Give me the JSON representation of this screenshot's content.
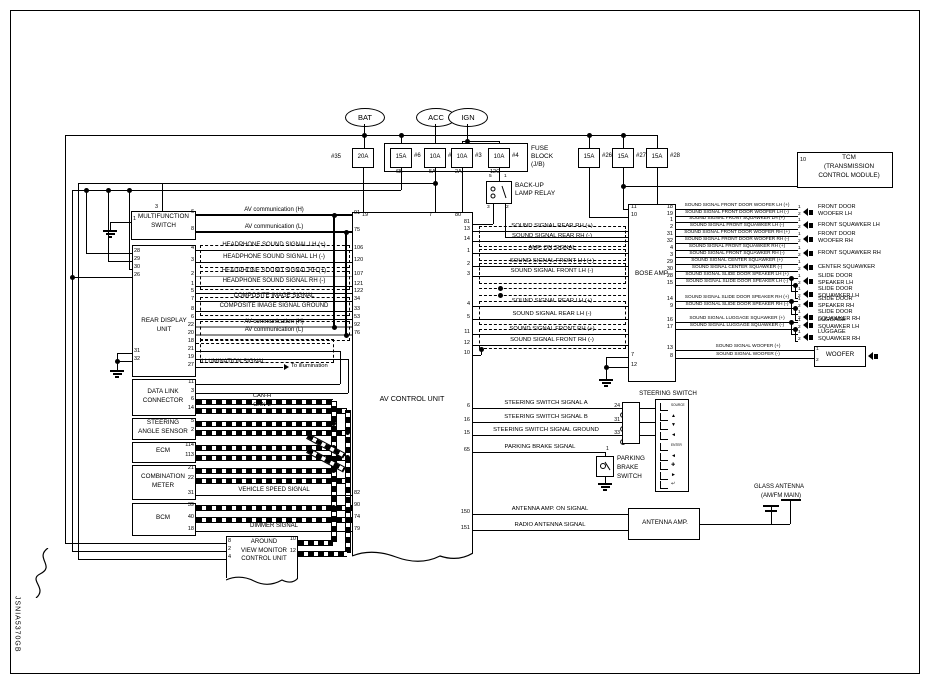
{
  "title_code": "JSNIA5370GB",
  "power_sources": [
    "BAT",
    "ACC",
    "IGN"
  ],
  "fuse_block": {
    "label_lines": [
      "FUSE",
      "BLOCK",
      "(J/B)"
    ],
    "fuses": [
      {
        "amps": "20A",
        "id": "#35",
        "tap": ""
      },
      {
        "amps": "15A",
        "id": "#6",
        "tap": "6B"
      },
      {
        "amps": "10A",
        "id": "#19",
        "tap": "5A"
      },
      {
        "amps": "10A",
        "id": "#3",
        "tap": "2A"
      },
      {
        "amps": "10A",
        "id": "#4",
        "tap": "12C"
      }
    ]
  },
  "extra_fuses": [
    {
      "amps": "15A",
      "id": "#26"
    },
    {
      "amps": "15A",
      "id": "#27"
    },
    {
      "amps": "15A",
      "id": "#28"
    }
  ],
  "backup_lamp_relay": {
    "label_lines": [
      "BACK-UP",
      "LAMP RELAY"
    ],
    "pins": [
      "5",
      "1",
      "3",
      "2"
    ]
  },
  "tcm": {
    "pin": "10",
    "label_lines": [
      "TCM",
      "(TRANSMISSION",
      "CONTROL MODULE)"
    ]
  },
  "multifunction_switch": {
    "label_lines": [
      "MULTIFUNCTION",
      "SWITCH"
    ],
    "top_pin": "3",
    "ground_pin": "1",
    "right_pins": [
      "6",
      "8"
    ]
  },
  "rear_display_unit": {
    "label_lines": [
      "REAR DISPLAY",
      "UNIT"
    ],
    "left_pins": [
      "28",
      "29",
      "30",
      "26",
      "31",
      "32"
    ],
    "right_pins": [
      "4",
      "3",
      "2",
      "1",
      "5",
      "7",
      "8",
      "6",
      "22",
      "20",
      "18",
      "21",
      "19",
      "27"
    ]
  },
  "upper_signals": [
    {
      "label": "AV communication (H)",
      "av_pin": "91"
    },
    {
      "label": "AV communication (L)",
      "av_pin": "75"
    },
    {
      "label": "HEADPHONE SOUND SIGNAL LH (+)",
      "av_pin": "106"
    },
    {
      "label": "HEADPHONE SOUND SIGNAL LH (-)",
      "av_pin": "120"
    },
    {
      "label": "HEADPHONE SOUND SIGNAL RH (+)",
      "av_pin": "107"
    },
    {
      "label": "HEADPHONE SOUND SIGNAL RH (-)",
      "av_pin": "121"
    },
    {
      "label": "",
      "av_pin": "122"
    },
    {
      "label": "COMPOSITE IMAGE SIGNAL",
      "av_pin": "34"
    },
    {
      "label": "COMPOSITE IMAGE SIGNAL GROUND",
      "av_pin": "33"
    },
    {
      "label": "",
      "av_pin": "53"
    },
    {
      "label": "AV communication (H)",
      "av_pin": "92"
    },
    {
      "label": "AV communication (L)",
      "av_pin": "76"
    }
  ],
  "illumination": {
    "label": "ILLUMINATION SIGNAL",
    "note": "To illumination",
    "rdu_pin": "27"
  },
  "av_control_unit": {
    "name": "AV CONTROL UNIT",
    "top_pins": [
      "19",
      "7",
      "80"
    ],
    "left_lower_pins": [
      "82",
      "90",
      "74",
      "79"
    ],
    "relay_feed_pin": "81",
    "shield_pin": "10"
  },
  "mid_signals": [
    {
      "label": "SOUND SIGNAL REAR RH (+)",
      "av_pin": "13",
      "amp_pin": "26"
    },
    {
      "label": "SOUND SIGNAL REAR RH (-)",
      "av_pin": "14",
      "amp_pin": "25"
    },
    {
      "label": "AMP. ON SIGNAL",
      "av_pin": "1",
      "amp_pin": "20"
    },
    {
      "label": "SOUND SIGNAL FRONT LH (+)",
      "av_pin": "2",
      "amp_pin": "35"
    },
    {
      "label": "SOUND SIGNAL FRONT LH (-)",
      "av_pin": "3",
      "amp_pin": "36"
    },
    {
      "label": "SOUND SIGNAL REAR LH (+)",
      "av_pin": "4",
      "amp_pin": "24"
    },
    {
      "label": "SOUND SIGNAL REAR LH (-)",
      "av_pin": "5",
      "amp_pin": "23"
    },
    {
      "label": "SOUND SIGNAL FRONT RH (+)",
      "av_pin": "11",
      "amp_pin": "33"
    },
    {
      "label": "SOUND SIGNAL FRONT RH (-)",
      "av_pin": "12",
      "amp_pin": "34"
    }
  ],
  "bose_amp": {
    "name": "BOSE AMP.",
    "supply_pins": [
      "11",
      "10"
    ],
    "ground_pins": [
      "7",
      "12"
    ],
    "right_pins": [
      "18",
      "19",
      "1",
      "2",
      "31",
      "32",
      "4",
      "3",
      "29",
      "30",
      "28",
      "15",
      "14",
      "9",
      "16",
      "17",
      "13",
      "8"
    ]
  },
  "speaker_signals": [
    {
      "label": "SOUND SIGNAL FRONT DOOR WOOFER LH (+)",
      "spk_pin": "1"
    },
    {
      "label": "SOUND SIGNAL FRONT DOOR WOOFER LH (-)",
      "spk_pin": "2"
    },
    {
      "label": "SOUND SIGNAL FRONT SQUAWKER LH (+)",
      "spk_pin": "1"
    },
    {
      "label": "SOUND SIGNAL FRONT SQUAWKER LH (-)",
      "spk_pin": "2"
    },
    {
      "label": "SOUND SIGNAL FRONT DOOR WOOFER RH (+)",
      "spk_pin": "1"
    },
    {
      "label": "SOUND SIGNAL FRONT DOOR WOOFER RH (-)",
      "spk_pin": "2"
    },
    {
      "label": "SOUND SIGNAL FRONT SQUAWKER RH (+)",
      "spk_pin": "1"
    },
    {
      "label": "SOUND SIGNAL FRONT SQUAWKER RH (-)",
      "spk_pin": "2"
    },
    {
      "label": "SOUND SIGNAL CENTER SQUAWKER (+)",
      "spk_pin": "1"
    },
    {
      "label": "SOUND SIGNAL CENTER SQUAWKER (-)",
      "spk_pin": "2"
    },
    {
      "label": "SOUND SIGNAL SLIDE DOOR SPEAKER LH (+)",
      "spk_pin": "1"
    },
    {
      "label": "SOUND SIGNAL SLIDE DOOR SPEAKER LH (-)",
      "spk_pin": "2"
    },
    {
      "label": "SOUND SIGNAL SLIDE DOOR SPEAKER RH (+)",
      "spk_pin": "1"
    },
    {
      "label": "SOUND SIGNAL SLIDE DOOR SPEAKER RH (-)",
      "spk_pin": "2"
    },
    {
      "label": "SOUND SIGNAL LUGGAGE SQUAWKER (+)",
      "spk_pin": "1"
    },
    {
      "label": "SOUND SIGNAL LUGGAGE SQUAWKER (-)",
      "spk_pin": "2"
    },
    {
      "label": "SOUND SIGNAL WOOFER (+)",
      "spk_pin": "1"
    },
    {
      "label": "SOUND SIGNAL WOOFER (-)",
      "spk_pin": "2"
    }
  ],
  "branch_pins": [
    "1",
    "2"
  ],
  "speakers": [
    [
      "FRONT DOOR",
      "WOOFER  LH"
    ],
    [
      "FRONT SQUAWKER LH"
    ],
    [
      "FRONT DOOR",
      "WOOFER  RH"
    ],
    [
      "FRONT SQUAWKER RH"
    ],
    [
      "CENTER SQUAWKER"
    ],
    [
      "SLIDE DOOR",
      "SPEAKER  LH"
    ],
    [
      "SLIDE DOOR",
      "SQUAWKER  LH"
    ],
    [
      "SLIDE DOOR",
      "SPEAKER  RH"
    ],
    [
      "SLIDE DOOR",
      "SQUAWKER  RH"
    ],
    [
      "LUGGAGE",
      "SQUAWKER  LH"
    ],
    [
      "LUGGAGE",
      "SQUAWKER  RH"
    ]
  ],
  "woofer_label": "WOOFER",
  "steering": {
    "title": "STEERING SWITCH",
    "rows": [
      {
        "label": "STEERING SWITCH SIGNAL A",
        "av_pin": "6",
        "conn_pin": "24",
        "switch_pin": "14"
      },
      {
        "label": "STEERING SWITCH SIGNAL B",
        "av_pin": "16",
        "conn_pin": "31",
        "switch_pin": "15"
      },
      {
        "label": "STEERING SWITCH SIGNAL GROUND",
        "av_pin": "15",
        "conn_pin": "33",
        "switch_pin": "17"
      }
    ],
    "buttons": [
      "SOURCE",
      "▲",
      "▼",
      "◄",
      "ENTER",
      "◄",
      "✚",
      "►",
      "↵"
    ]
  },
  "parking_brake": {
    "label": "PARKING BRAKE SIGNAL",
    "av_pin": "65",
    "switch_pin": "1",
    "name_lines": [
      "PARKING",
      "BRAKE",
      "SWITCH"
    ]
  },
  "antenna": {
    "rows": [
      {
        "label": "ANTENNA AMP. ON SIGNAL",
        "av_pin": "150",
        "amp_pin": "1"
      },
      {
        "label": "RADIO ANTENNA SIGNAL",
        "av_pin": "151",
        "amp_pin": "2"
      }
    ],
    "amp_name": "ANTENNA AMP.",
    "glass_lines": [
      "GLASS ANTENNA",
      "(AM/FM MAIN)"
    ]
  },
  "can": {
    "h": "CAN-H",
    "l": "CAN-L"
  },
  "lower_components": [
    {
      "name_lines": [
        "DATA LINK",
        "CONNECTOR"
      ],
      "pins": [
        "11",
        "3",
        "6",
        "14"
      ]
    },
    {
      "name_lines": [
        "STEERING",
        "ANGLE SENSOR"
      ],
      "pins": [
        "5",
        "2"
      ]
    },
    {
      "name_lines": [
        "ECM"
      ],
      "pins": [
        "114",
        "113"
      ]
    },
    {
      "name_lines": [
        "COMBINATION",
        "METER"
      ],
      "pins": [
        "21",
        "22",
        "31"
      ]
    },
    {
      "name_lines": [
        "BCM"
      ],
      "pins": [
        "39",
        "40",
        "18"
      ]
    }
  ],
  "lower_signals": {
    "vehicle_speed": {
      "label": "VEHICLE SPEED SIGNAL",
      "av_pin": "82"
    },
    "dimmer": {
      "label": "DIMMER SIGNAL",
      "av_pin": "79"
    },
    "can_av_pins": [
      "90",
      "74"
    ]
  },
  "around_view": {
    "name_lines": [
      "AROUND",
      "VIEW MONITOR",
      "CONTROL UNIT"
    ],
    "left_pins": [
      "8",
      "2",
      "4"
    ],
    "right_pins": [
      "10",
      "12"
    ]
  }
}
